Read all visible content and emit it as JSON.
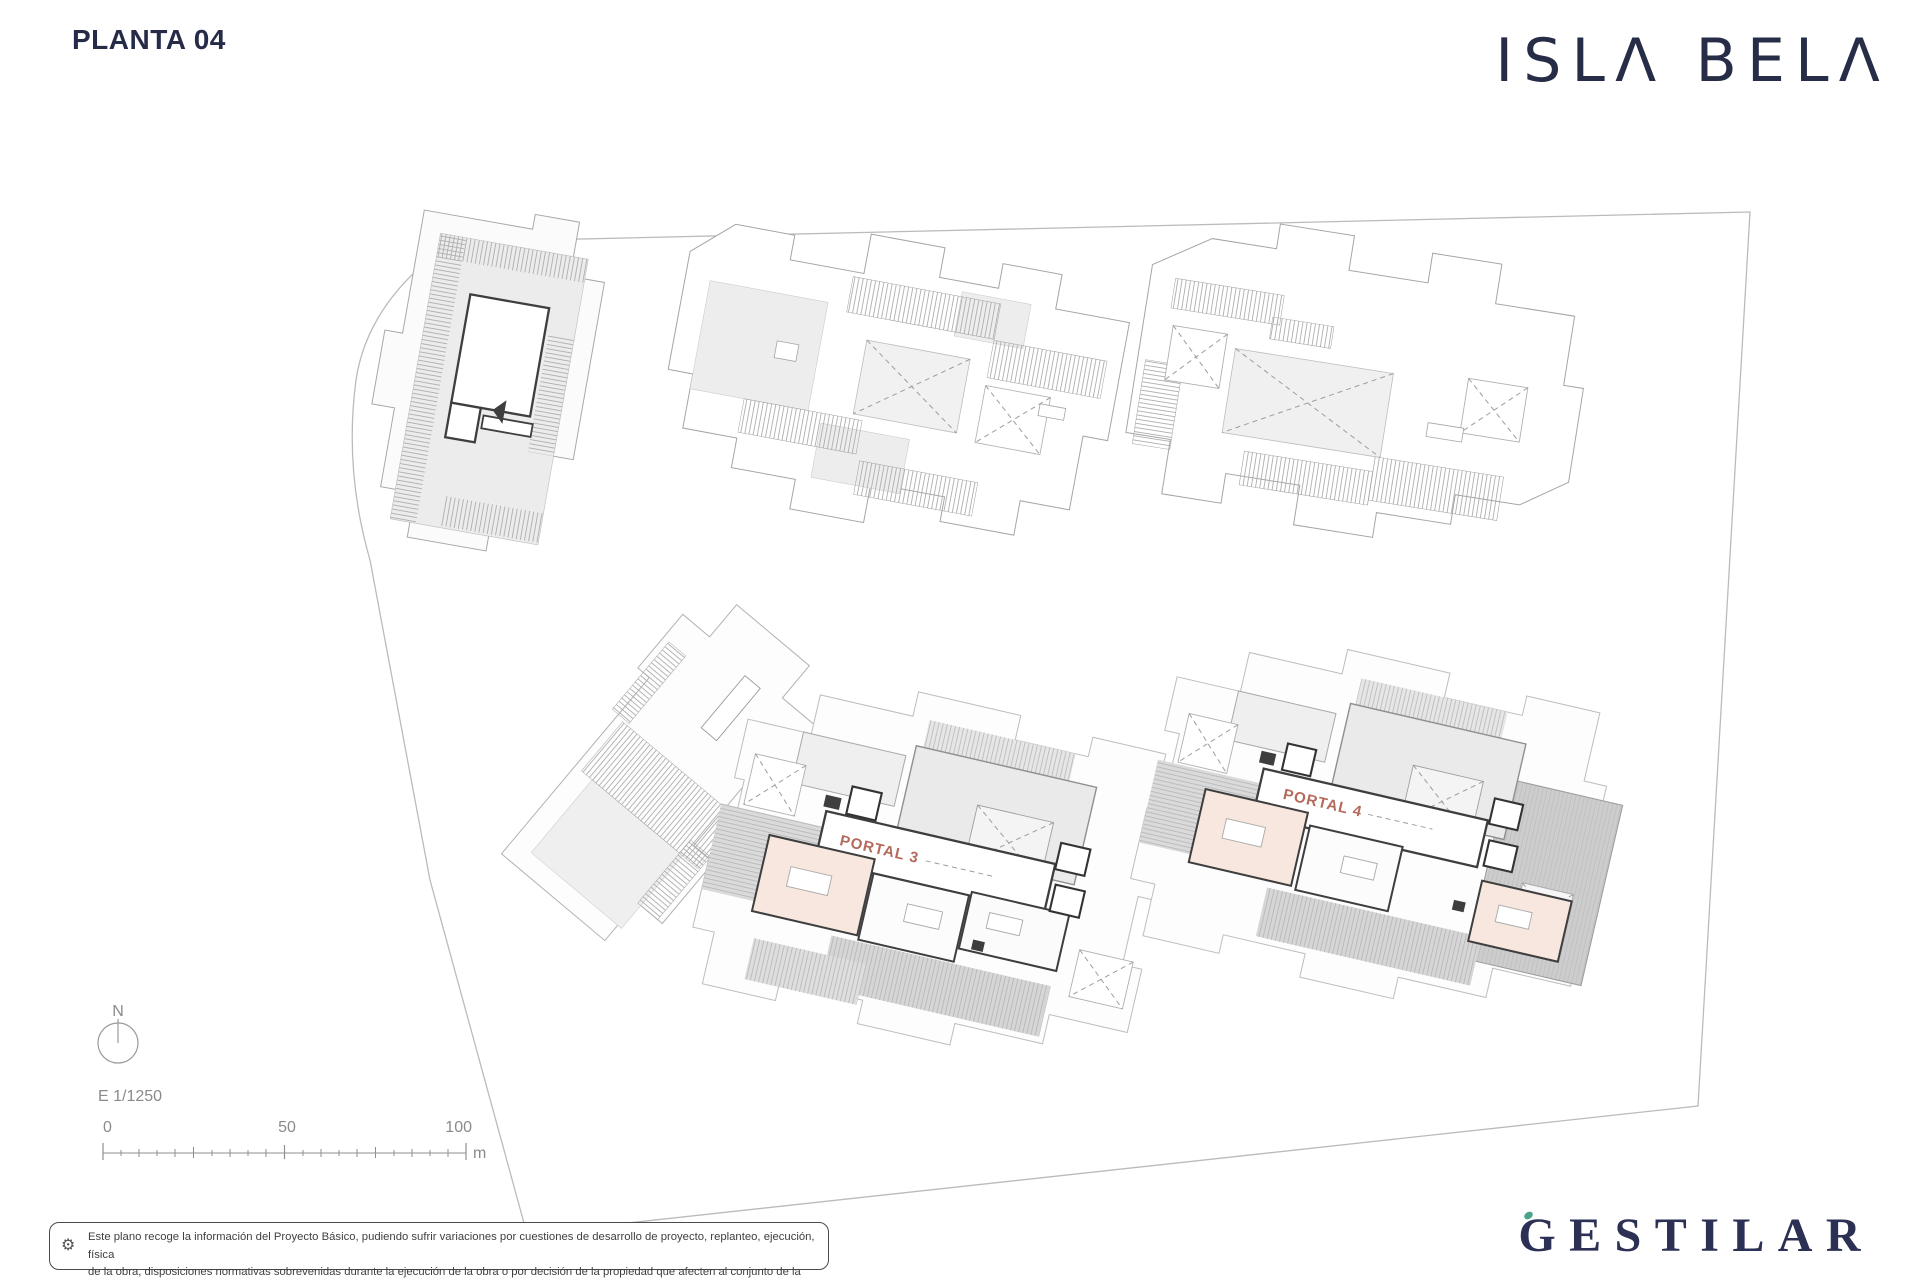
{
  "header": {
    "title": "PLANTA 04",
    "brand": "ISLA BELA"
  },
  "footer": {
    "developer": "GESTILAR"
  },
  "plan": {
    "floor": "PLANTA 04",
    "portal_labels": [
      {
        "label": "PORTAL 3"
      },
      {
        "label": "PORTAL 4"
      }
    ]
  },
  "compass": {
    "north": "N"
  },
  "scalebar": {
    "ratio": "E 1/1250",
    "ticks": [
      "0",
      "50",
      "100"
    ],
    "unit": "m"
  },
  "disclaimer": {
    "icon": "gear-icon",
    "icon_glyph": "⚙",
    "line1": "Este plano recoge la información del Proyecto Básico, pudiendo sufrir variaciones por cuestiones de desarrollo de proyecto, replanteo, ejecución, física",
    "line2": "de la obra, disposiciones normativas sobrevenidas durante la ejecución de la obra o por decisión de la propiedad que afecten al conjunto de la obra."
  },
  "colors": {
    "navy": "#262b48",
    "portal_red": "#a8503f",
    "accent_green": "#49a289",
    "line_gray": "#9b9b9b",
    "roof_gray": "#ececec",
    "terrace_gray": "#d8d8d8",
    "room_pink": "#f7e7de"
  }
}
